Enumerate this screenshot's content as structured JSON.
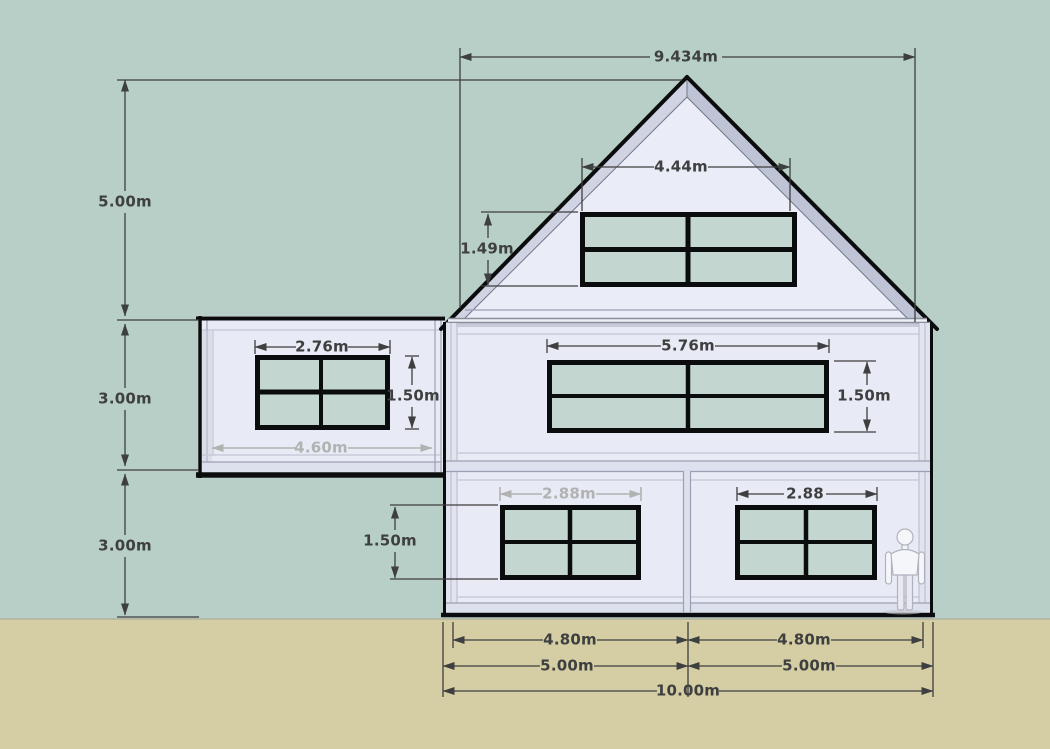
{
  "colors": {
    "sky": "#b8cfc8",
    "ground": "#d5cda4",
    "wall": "#e8eaf5",
    "gable": "#eaecf8",
    "glass": "#c3d7d0",
    "frame": "#0b0c0d",
    "fascia_light": "#d0d3e1",
    "fascia_dark": "#bfc3d6",
    "dim_dark": "#3e3f3f",
    "dim_light": "#b0b3b1"
  },
  "dimensions": {
    "roof": {
      "slope": "9.434m",
      "height": "5.00m"
    },
    "left": {
      "floor2": "3.00m",
      "floor1": "3.00m"
    },
    "attic": {
      "window_width": "4.44m",
      "window_height": "1.49m"
    },
    "annex": {
      "window_width": "2.76m",
      "window_height": "1.50m",
      "width": "4.60m"
    },
    "floor2": {
      "window_width": "5.76m",
      "window_height": "1.50m"
    },
    "ground": {
      "left_window_width": "2.88m",
      "right_window_width": "2.88",
      "window_height": "1.50m"
    },
    "bottom": {
      "left_inner": "4.80m",
      "right_inner": "4.80m",
      "left_half": "5.00m",
      "right_half": "5.00m",
      "total": "10.00m"
    }
  }
}
